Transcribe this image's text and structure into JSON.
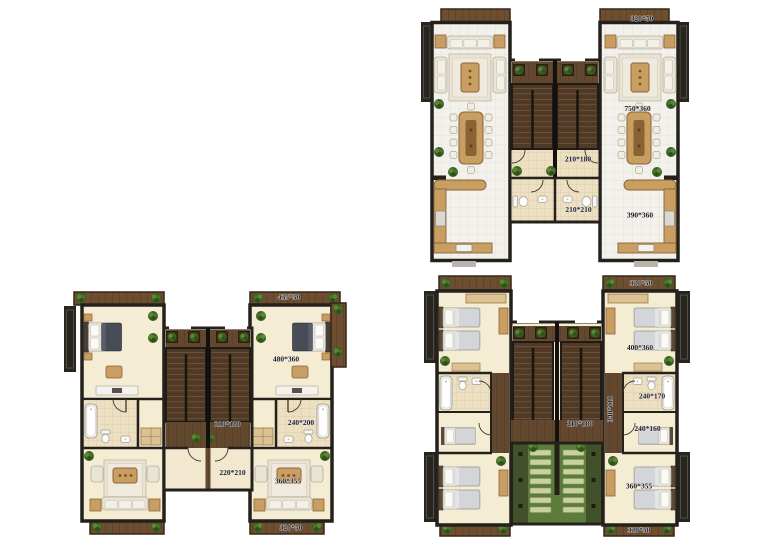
{
  "page": {
    "background": "#ffffff",
    "description": "Three architectural floor plans of a mirrored twin villa (ground, first and second floor)"
  },
  "colors": {
    "wall": "#24201b",
    "wood_deck": "#6e4e31",
    "stair_wood": "#503a27",
    "tile_white": "#f3f1ec",
    "tile_beige": "#ecdfc2",
    "floor_cream": "#f5ecd4",
    "counter_tan": "#c99e63",
    "plant_green": "#4c752c",
    "pergola_green": "#5d7c3c",
    "label_text": "#1b1f38"
  },
  "plans": {
    "ground_floor": {
      "labels": {
        "balcony_top": "320*50",
        "living_room": "750*360",
        "hall": "210*180",
        "bathroom": "210*210",
        "kitchen": "390*360"
      }
    },
    "first_floor": {
      "labels": {
        "balcony_top": "435*50",
        "bedroom": "480*360",
        "hall": "210*180",
        "bathroom": "240*200",
        "corridor": "220*210",
        "living_room": "360*355",
        "balcony_bottom": "320*50"
      }
    },
    "second_floor": {
      "labels": {
        "balcony_top": "320*50",
        "bedroom_top": "400*360",
        "bathroom": "240*170",
        "corridor": "340*110",
        "hall": "210*180",
        "dressing": "240*160",
        "bedroom_bottom": "360*355",
        "balcony_bottom": "320*50"
      }
    }
  }
}
